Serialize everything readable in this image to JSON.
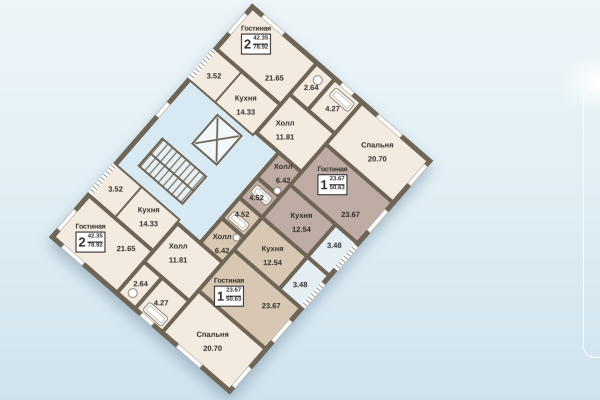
{
  "palette": {
    "background_top": "#edf5f9",
    "background_bottom": "#cfe3ee",
    "wall": "#6f6557",
    "cream": "#f3eae0",
    "mauve": "#bfaca4",
    "tan": "#d8c7b2",
    "core_blue": "#d7e9f2",
    "balcony_blue": "#e4eef3",
    "ink": "#2f2c28"
  },
  "icons": {
    "elevator": "x-crossed-shaft-box",
    "stairs": "tread-stripes",
    "bathtub": "rounded-rect",
    "toilet": "circle",
    "window": "white-wall-dash",
    "balcony_rail": "striped-dash"
  },
  "plan": {
    "rotation_deg": 41,
    "apartments": [
      {
        "kind": "two-room-top",
        "header": {
          "title": "Гостиная",
          "rooms_count": "2",
          "living_area": "42.35",
          "total_area": "78.92"
        },
        "rooms": [
          {
            "name": "",
            "area": "21.65"
          },
          {
            "name": "",
            "area": "2.64"
          },
          {
            "name": "",
            "area": "4.27"
          },
          {
            "name": "Холл",
            "area": "11.81"
          },
          {
            "name": "",
            "area": "3.52"
          },
          {
            "name": "Кухня",
            "area": "14.33"
          },
          {
            "name": "Спальня",
            "area": "20.70"
          }
        ]
      },
      {
        "kind": "one-room-upper",
        "header": {
          "title": "Гостиная",
          "rooms_count": "1",
          "living_area": "23.67",
          "total_area": "50.63"
        },
        "rooms": [
          {
            "name": "",
            "area": "23.67"
          },
          {
            "name": "Холл",
            "area": "6.42"
          },
          {
            "name": "",
            "area": "4.52"
          },
          {
            "name": "Кухня",
            "area": "12.54"
          },
          {
            "name": "",
            "area": "3.48"
          }
        ]
      },
      {
        "kind": "one-room-lower",
        "header": {
          "title": "Гостиная",
          "rooms_count": "1",
          "living_area": "23.67",
          "total_area": "50.63"
        },
        "rooms": [
          {
            "name": "",
            "area": "23.67"
          },
          {
            "name": "Холл",
            "area": "6.42"
          },
          {
            "name": "",
            "area": "4.52"
          },
          {
            "name": "Кухня",
            "area": "12.54"
          },
          {
            "name": "",
            "area": "3.48"
          }
        ]
      },
      {
        "kind": "two-room-bottom",
        "header": {
          "title": "Гостиная",
          "rooms_count": "2",
          "living_area": "42.35",
          "total_area": "78.92"
        },
        "rooms": [
          {
            "name": "",
            "area": "21.65"
          },
          {
            "name": "",
            "area": "2.64"
          },
          {
            "name": "",
            "area": "4.27"
          },
          {
            "name": "Холл",
            "area": "11.81"
          },
          {
            "name": "",
            "area": "3.52"
          },
          {
            "name": "Кухня",
            "area": "14.33"
          },
          {
            "name": "Спальня",
            "area": "20.70"
          }
        ]
      }
    ]
  }
}
